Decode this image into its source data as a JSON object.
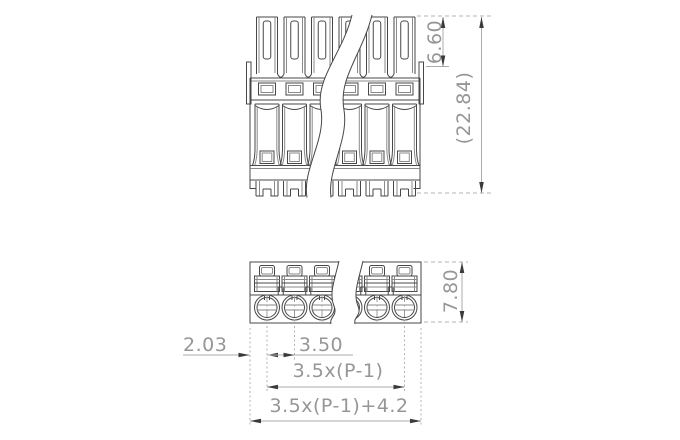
{
  "drawing": {
    "type": "technical-drawing-terminal-block",
    "poles_visible": 6,
    "dimensions": {
      "tower_height": "6.60",
      "overall_height": "(22.84)",
      "plan_depth": "7.80",
      "edge_to_first_pole": "2.03",
      "pole_pitch": "3.50",
      "poles_span_formula": "3.5x(P-1)",
      "overall_width_formula": "3.5x(P-1)+4.2"
    },
    "colors": {
      "background": "#ffffff",
      "outline": "#474747",
      "outline_light": "#8a8a8a",
      "dimension_line": "#ababab",
      "extension_line": "#b3b3b3",
      "arrow": "#3a3a3a",
      "dimension_text": "#969696",
      "centerline": "#9c9c9c"
    }
  }
}
